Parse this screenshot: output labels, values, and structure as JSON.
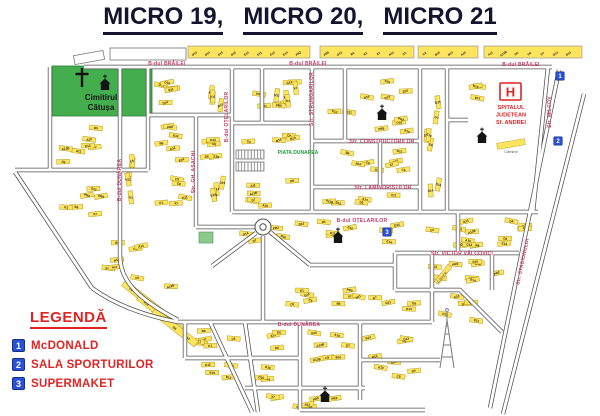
{
  "title": {
    "parts": [
      "MICRO 19,",
      "MICRO 20,",
      "MICRO 21"
    ]
  },
  "legend": {
    "title": "LEGENDĂ",
    "items": [
      {
        "num": "1",
        "label": "McDONALD"
      },
      {
        "num": "2",
        "label": "SALA SPORTURILOR"
      },
      {
        "num": "3",
        "label": "SUPERMAKET"
      }
    ]
  },
  "colors": {
    "street_label": "#c43a6c",
    "accent_red": "#e02424",
    "cemetery_green": "#44ae4e",
    "building_yellow": "#ffe55e",
    "building_border": "#b09a20",
    "marker_blue": "#2b50d8",
    "road_outline": "#4f4f4f",
    "title_color": "#14142e",
    "green_text": "#1f9e3c"
  },
  "map": {
    "street_labels": [
      {
        "text": "B-dul BRĂILEI",
        "x": 167,
        "y": 65,
        "rot": 0
      },
      {
        "text": "B-dul BRĂILEI",
        "x": 308,
        "y": 65,
        "rot": 0
      },
      {
        "text": "B-dul BRĂILEI",
        "x": 521,
        "y": 66,
        "rot": 0
      },
      {
        "text": "B-dul DUNĂREA",
        "x": 121,
        "y": 180,
        "rot": -90
      },
      {
        "text": "B-dul DUNĂREA",
        "x": 299,
        "y": 326,
        "rot": 0
      },
      {
        "text": "B-dul OȚELARILOR",
        "x": 228,
        "y": 117,
        "rot": -90
      },
      {
        "text": "B-dul OȚELARILOR",
        "x": 362,
        "y": 222,
        "rot": 0
      },
      {
        "text": "Str. GH. ASACHI",
        "x": 195,
        "y": 172,
        "rot": -90
      },
      {
        "text": "Str. STRUNGARILOR",
        "x": 313,
        "y": 99,
        "rot": -90
      },
      {
        "text": "Str. CONSTRUCTORILOR",
        "x": 382,
        "y": 143,
        "rot": 0
      },
      {
        "text": "Str. LAMINORIȘTILOR",
        "x": 383,
        "y": 189,
        "rot": 0
      },
      {
        "text": "Str. VICTOR VÂLCOVICI",
        "x": 462,
        "y": 255,
        "rot": 0
      },
      {
        "text": "Str. MILCOV",
        "x": 551,
        "y": 112,
        "rot": -90
      },
      {
        "text": "Str. STADIONULUI",
        "x": 524,
        "y": 262,
        "rot": -78
      }
    ],
    "area_labels": [
      {
        "text": "Cimitirul",
        "x": 101,
        "y": 100,
        "size": 8,
        "color": "#151515",
        "rot": 0,
        "bold": true
      },
      {
        "text": "Cătușa",
        "x": 101,
        "y": 110,
        "size": 8,
        "color": "#151515",
        "rot": 0,
        "bold": true
      },
      {
        "text": "PIATA DUNAREA",
        "x": 298,
        "y": 154,
        "size": 5,
        "color": "#1f9e3c",
        "rot": 0,
        "bold": true
      },
      {
        "text": "Cămine",
        "x": 511,
        "y": 153,
        "size": 4,
        "color": "#5a5a5a",
        "rot": 0,
        "bold": false
      },
      {
        "text": "Cămine",
        "x": 443,
        "y": 278,
        "size": 4,
        "color": "#5a5a5a",
        "rot": -52,
        "bold": false
      }
    ],
    "hospital": {
      "symbol": "H",
      "lines": [
        "SPITALUL",
        "JUDETEAN",
        "Sf. ANDREI"
      ]
    },
    "markers": [
      {
        "num": "1",
        "x": 560,
        "y": 76
      },
      {
        "num": "2",
        "x": 558,
        "y": 141
      },
      {
        "num": "3",
        "x": 387,
        "y": 232
      }
    ],
    "churches": [
      [
        105,
        90
      ],
      [
        382,
        120
      ],
      [
        338,
        243
      ],
      [
        482,
        143
      ],
      [
        325,
        402
      ]
    ],
    "cross": {
      "x": 82,
      "y": 70
    },
    "tower": {
      "x": 447,
      "y": 368
    },
    "building_labels": [
      "A10",
      "A11",
      "A13B",
      "D5",
      "D6",
      "D7",
      "D13",
      "D14",
      "D15",
      "D16",
      "E10",
      "E11",
      "E12",
      "E14",
      "PR2",
      "PR5",
      "G12",
      "B6",
      "K1",
      "X7",
      "N11",
      "C5",
      "C8",
      "B10",
      "B13"
    ]
  }
}
